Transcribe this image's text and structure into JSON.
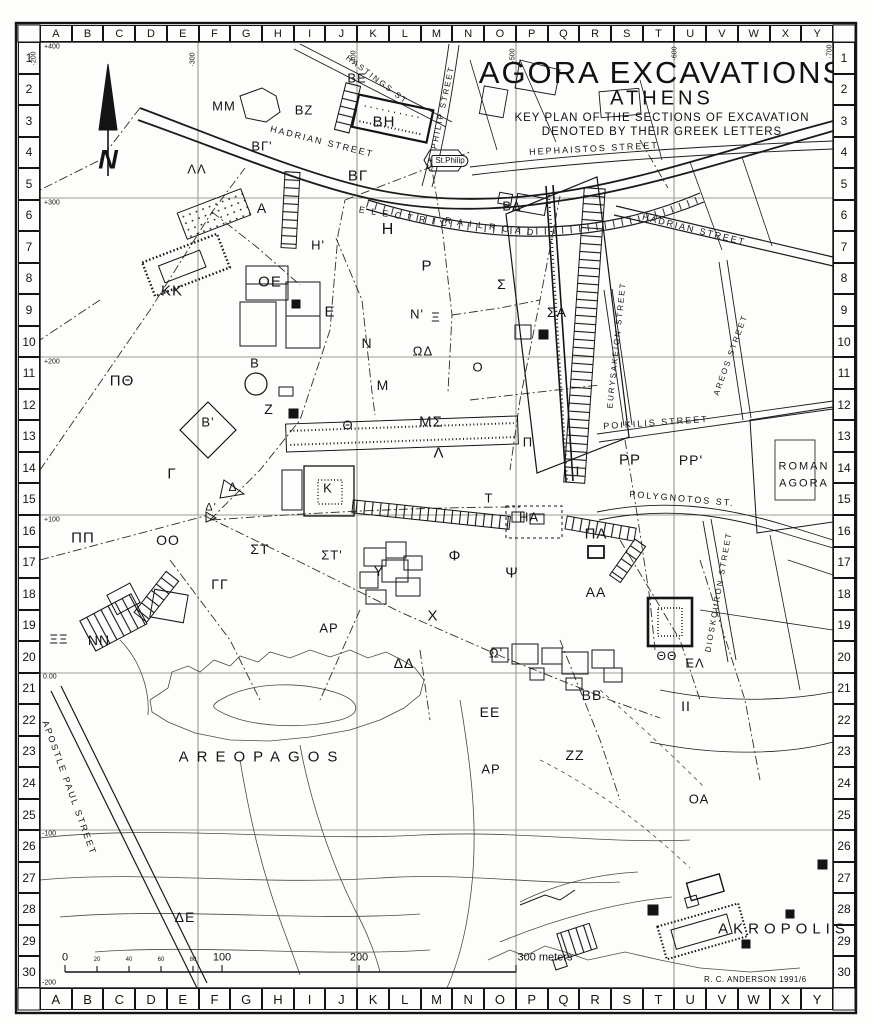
{
  "title": {
    "line1": "AGORA EXCAVATIONS",
    "line2": "ATHENS",
    "line3": "KEY PLAN OF THE SECTIONS OF EXCAVATION",
    "line4": "DENOTED BY THEIR GREEK LETTERS"
  },
  "credit": "R. C. ANDERSON   1991/6",
  "north_label": "N",
  "frame": {
    "letters": [
      "A",
      "B",
      "C",
      "D",
      "E",
      "F",
      "G",
      "H",
      "I",
      "J",
      "K",
      "L",
      "M",
      "N",
      "O",
      "P",
      "Q",
      "R",
      "S",
      "T",
      "U",
      "V",
      "W",
      "X",
      "Y"
    ],
    "numbers": [
      "1",
      "2",
      "3",
      "4",
      "5",
      "6",
      "7",
      "8",
      "9",
      "10",
      "11",
      "12",
      "13",
      "14",
      "15",
      "16",
      "17",
      "18",
      "19",
      "20",
      "21",
      "22",
      "23",
      "24",
      "25",
      "26",
      "27",
      "28",
      "29",
      "30"
    ]
  },
  "grid_refs": {
    "left": [
      {
        "t": "+400",
        "x": 44,
        "y": 47
      },
      {
        "t": "+300",
        "x": 44,
        "y": 203
      },
      {
        "t": "+200",
        "x": 44,
        "y": 362
      },
      {
        "t": "+100",
        "x": 44,
        "y": 520
      },
      {
        "t": "0.00",
        "x": 43,
        "y": 677
      },
      {
        "t": "-100",
        "x": 42,
        "y": 834
      },
      {
        "t": "-200",
        "x": 42,
        "y": 983
      }
    ],
    "top": [
      {
        "t": "·200",
        "x": 34,
        "y": 55
      },
      {
        "t": "·300",
        "x": 193,
        "y": 56
      },
      {
        "t": "·400",
        "x": 354,
        "y": 54
      },
      {
        "t": "·500",
        "x": 513,
        "y": 52
      },
      {
        "t": "·600",
        "x": 675,
        "y": 50
      },
      {
        "t": "·700",
        "x": 830,
        "y": 48
      }
    ]
  },
  "scale_bar": {
    "major": [
      {
        "t": "0",
        "x": 65
      },
      {
        "t": "100",
        "x": 222
      },
      {
        "t": "200",
        "x": 359
      },
      {
        "t": "300 meters",
        "x": 545
      }
    ],
    "minor": [
      {
        "t": "20",
        "x": 97
      },
      {
        "t": "40",
        "x": 129
      },
      {
        "t": "60",
        "x": 161
      },
      {
        "t": "80",
        "x": 193
      }
    ]
  },
  "sections": [
    {
      "t": "ΜΜ",
      "x": 224,
      "y": 106
    },
    {
      "t": "ΒΕ",
      "x": 357,
      "y": 78
    },
    {
      "t": "ΒΖ",
      "x": 304,
      "y": 110
    },
    {
      "t": "ΒΗ",
      "x": 384,
      "y": 122,
      "fs": 15
    },
    {
      "t": "ΒΓ'",
      "x": 262,
      "y": 146
    },
    {
      "t": "ΛΛ",
      "x": 197,
      "y": 169
    },
    {
      "t": "ΒΓ",
      "x": 358,
      "y": 176,
      "fs": 15
    },
    {
      "t": "Α",
      "x": 262,
      "y": 208,
      "fs": 14
    },
    {
      "t": "ΒΔ",
      "x": 512,
      "y": 206
    },
    {
      "t": "Η",
      "x": 388,
      "y": 230,
      "fs": 16
    },
    {
      "t": "Η'",
      "x": 318,
      "y": 245
    },
    {
      "t": "Ρ",
      "x": 427,
      "y": 266,
      "fs": 15
    },
    {
      "t": "Σ",
      "x": 502,
      "y": 284,
      "fs": 14
    },
    {
      "t": "ΣΑ",
      "x": 557,
      "y": 312,
      "fs": 14
    },
    {
      "t": "ΚΚ",
      "x": 172,
      "y": 291,
      "fs": 15
    },
    {
      "t": "ΟΕ",
      "x": 270,
      "y": 282,
      "fs": 15
    },
    {
      "t": "Ε",
      "x": 330,
      "y": 312,
      "fs": 15
    },
    {
      "t": "Ν'",
      "x": 417,
      "y": 314
    },
    {
      "t": "Ξ",
      "x": 436,
      "y": 317
    },
    {
      "t": "Ν",
      "x": 367,
      "y": 343,
      "fs": 14
    },
    {
      "t": "ΩΔ",
      "x": 423,
      "y": 351
    },
    {
      "t": "Ο",
      "x": 478,
      "y": 367
    },
    {
      "t": "Β",
      "x": 255,
      "y": 363
    },
    {
      "t": "Μ",
      "x": 383,
      "y": 385,
      "fs": 14
    },
    {
      "t": "ΠΘ",
      "x": 122,
      "y": 381,
      "fs": 15
    },
    {
      "t": "Ζ",
      "x": 269,
      "y": 409,
      "fs": 14
    },
    {
      "t": "Β'",
      "x": 208,
      "y": 422
    },
    {
      "t": "Θ",
      "x": 348,
      "y": 425
    },
    {
      "t": "ΜΣ",
      "x": 431,
      "y": 422,
      "fs": 15
    },
    {
      "t": "Λ",
      "x": 439,
      "y": 453,
      "fs": 15
    },
    {
      "t": "Π",
      "x": 528,
      "y": 442
    },
    {
      "t": "Γ",
      "x": 172,
      "y": 474,
      "fs": 15
    },
    {
      "t": "Δ",
      "x": 233,
      "y": 487,
      "fs": 12
    },
    {
      "t": "Κ",
      "x": 328,
      "y": 488
    },
    {
      "t": "Δ'",
      "x": 211,
      "y": 508,
      "fs": 11
    },
    {
      "t": "Τ",
      "x": 489,
      "y": 498
    },
    {
      "t": "Ι",
      "x": 578,
      "y": 471,
      "fs": 14
    },
    {
      "t": "ΡΡ",
      "x": 630,
      "y": 460,
      "fs": 15
    },
    {
      "t": "ΡΡ'",
      "x": 691,
      "y": 460,
      "fs": 14
    },
    {
      "t": "ΗΑ",
      "x": 529,
      "y": 517
    },
    {
      "t": "ΠΑ",
      "x": 596,
      "y": 534,
      "fs": 15
    },
    {
      "t": "ΠΠ",
      "x": 83,
      "y": 538,
      "fs": 15
    },
    {
      "t": "ΟΟ",
      "x": 168,
      "y": 540,
      "fs": 14
    },
    {
      "t": "ΣΤ",
      "x": 260,
      "y": 549,
      "fs": 14
    },
    {
      "t": "ΣΤ'",
      "x": 332,
      "y": 555
    },
    {
      "t": "Υ",
      "x": 379,
      "y": 571,
      "fs": 14
    },
    {
      "t": "Φ",
      "x": 455,
      "y": 556,
      "fs": 15
    },
    {
      "t": "Ψ",
      "x": 512,
      "y": 573,
      "fs": 15
    },
    {
      "t": "ΑΑ",
      "x": 596,
      "y": 592,
      "fs": 14
    },
    {
      "t": "ΓΓ",
      "x": 220,
      "y": 584,
      "fs": 14
    },
    {
      "t": "Χ",
      "x": 433,
      "y": 616,
      "fs": 15
    },
    {
      "t": "ΑΡ",
      "x": 329,
      "y": 628
    },
    {
      "t": "ΞΞ",
      "x": 59,
      "y": 639
    },
    {
      "t": "ΝΝ",
      "x": 99,
      "y": 640,
      "fs": 14
    },
    {
      "t": "ΔΔ",
      "x": 404,
      "y": 663,
      "fs": 14
    },
    {
      "t": "Ω'",
      "x": 496,
      "y": 653
    },
    {
      "t": "ΒΒ",
      "x": 592,
      "y": 695,
      "fs": 14
    },
    {
      "t": "ΕΕ",
      "x": 490,
      "y": 712,
      "fs": 14
    },
    {
      "t": "ΖΖ",
      "x": 575,
      "y": 755,
      "fs": 14
    },
    {
      "t": "ΘΘ",
      "x": 667,
      "y": 656,
      "fs": 12
    },
    {
      "t": "ΕΛ",
      "x": 695,
      "y": 663
    },
    {
      "t": "ΙΙ",
      "x": 686,
      "y": 706,
      "fs": 14
    },
    {
      "t": "ΑΡ",
      "x": 491,
      "y": 769
    },
    {
      "t": "ΟΑ",
      "x": 699,
      "y": 799
    },
    {
      "t": "ΔΕ",
      "x": 185,
      "y": 917,
      "fs": 14
    }
  ],
  "streets": [
    {
      "t": "HASTINGS  ST.",
      "x": 378,
      "y": 81,
      "r": 37,
      "fs": 8
    },
    {
      "t": "ST. PHILIP STREET",
      "x": 441,
      "y": 118,
      "r": -78,
      "fs": 8
    },
    {
      "t": "HADRIAN  STREET",
      "x": 322,
      "y": 142,
      "r": 14,
      "fs": 9
    },
    {
      "t": "HEPHAISTOS  STREET",
      "x": 594,
      "y": 149,
      "r": -3,
      "fs": 9
    },
    {
      "t": "E L E C T R I C",
      "x": 404,
      "y": 217,
      "r": 9,
      "fs": 9
    },
    {
      "t": "R A I L R O A D",
      "x": 490,
      "y": 227,
      "r": 8,
      "fs": 9
    },
    {
      "t": "HADRIAN  STREET",
      "x": 694,
      "y": 230,
      "r": 14,
      "fs": 9
    },
    {
      "t": "EURYSAKEION  STREET",
      "x": 617,
      "y": 345,
      "r": -84,
      "fs": 8
    },
    {
      "t": "AREOS  STREET",
      "x": 731,
      "y": 355,
      "r": -70,
      "fs": 8
    },
    {
      "t": "POIKILIS  STREET",
      "x": 656,
      "y": 423,
      "r": -4,
      "fs": 9
    },
    {
      "t": "POLYGNOTOS  ST.",
      "x": 682,
      "y": 499,
      "r": 5,
      "fs": 9
    },
    {
      "t": "DIOSKOURON  STREET",
      "x": 719,
      "y": 592,
      "r": -80,
      "fs": 8
    },
    {
      "t": "APOSTLE  PAUL  STREET",
      "x": 69,
      "y": 788,
      "r": 70,
      "fs": 9
    }
  ],
  "places": [
    {
      "t": "ROMAN",
      "x": 804,
      "y": 467,
      "fs": 11,
      "ls": 2
    },
    {
      "t": "AGORA",
      "x": 804,
      "y": 484,
      "fs": 11,
      "ls": 2
    },
    {
      "t": "AREOPAGOS",
      "x": 262,
      "y": 757,
      "fs": 15,
      "ls": 8
    },
    {
      "t": "AKROPOLIS",
      "x": 784,
      "y": 929,
      "fs": 15,
      "ls": 5
    },
    {
      "t": "St.Philip",
      "x": 450,
      "y": 161,
      "fs": 8,
      "ls": 0,
      "boxed": true
    }
  ]
}
